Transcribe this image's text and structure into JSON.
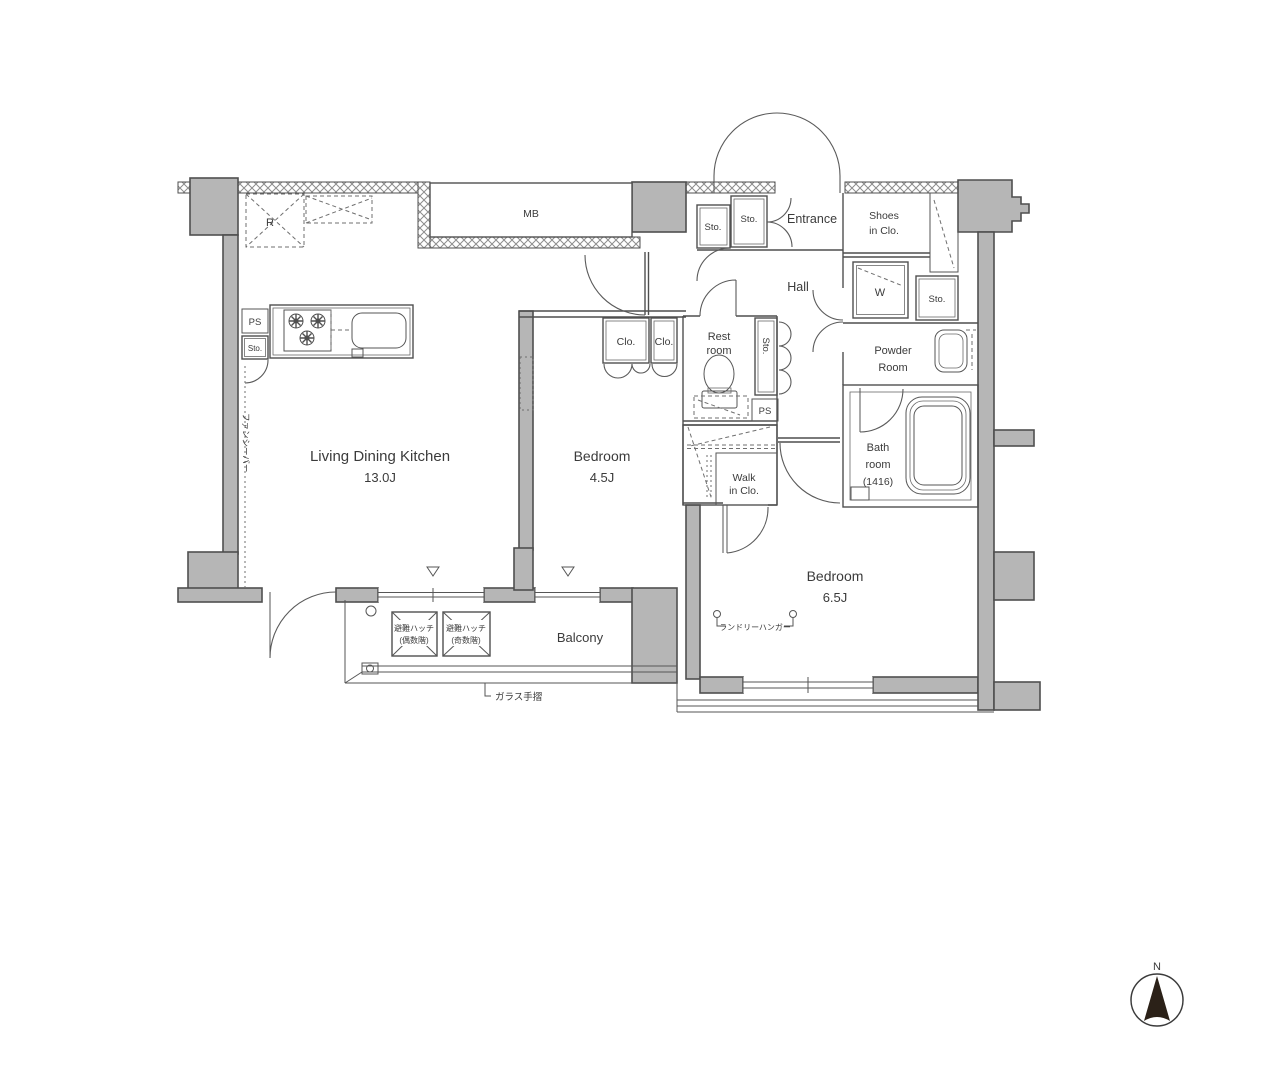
{
  "title": "apartment-floor-plan",
  "colors": {
    "wall_fill": "#b6b6b6",
    "wall_stroke": "#4f4f4f",
    "line": "#565656",
    "text": "#3b3b3b",
    "background": "#ffffff",
    "compass_fill": "#2b2118"
  },
  "rooms": {
    "ldk": {
      "name": "Living Dining Kitchen",
      "size": "13.0J"
    },
    "bedroom1": {
      "name": "Bedroom",
      "size": "4.5J"
    },
    "bedroom2": {
      "name": "Bedroom",
      "size": "6.5J"
    },
    "entrance": {
      "name": "Entrance"
    },
    "hall": {
      "name": "Hall"
    },
    "restroom": {
      "line1": "Rest",
      "line2": "room"
    },
    "powder": {
      "line1": "Powder",
      "line2": "Room"
    },
    "bath": {
      "line1": "Bath",
      "line2": "room",
      "line3": "(1416)"
    },
    "shoes": {
      "line1": "Shoes",
      "line2": "in Clo."
    },
    "wic": {
      "line1": "Walk",
      "line2": "in Clo."
    },
    "balcony": {
      "name": "Balcony"
    }
  },
  "labels": {
    "sto": "Sto.",
    "ps": "PS",
    "mb": "MB",
    "r": "R",
    "w": "W",
    "clo": "Clo.",
    "north": "N"
  },
  "annotations": {
    "hatch_even": {
      "line1": "避難ハッチ",
      "line2": "(偶数階)"
    },
    "hatch_odd": {
      "line1": "避難ハッチ",
      "line2": "(奇数階)"
    },
    "glass_rail": "ガラス手摺",
    "laundry_hanger": "ランドリーハンガー",
    "side_note": "ファンシーバー"
  }
}
